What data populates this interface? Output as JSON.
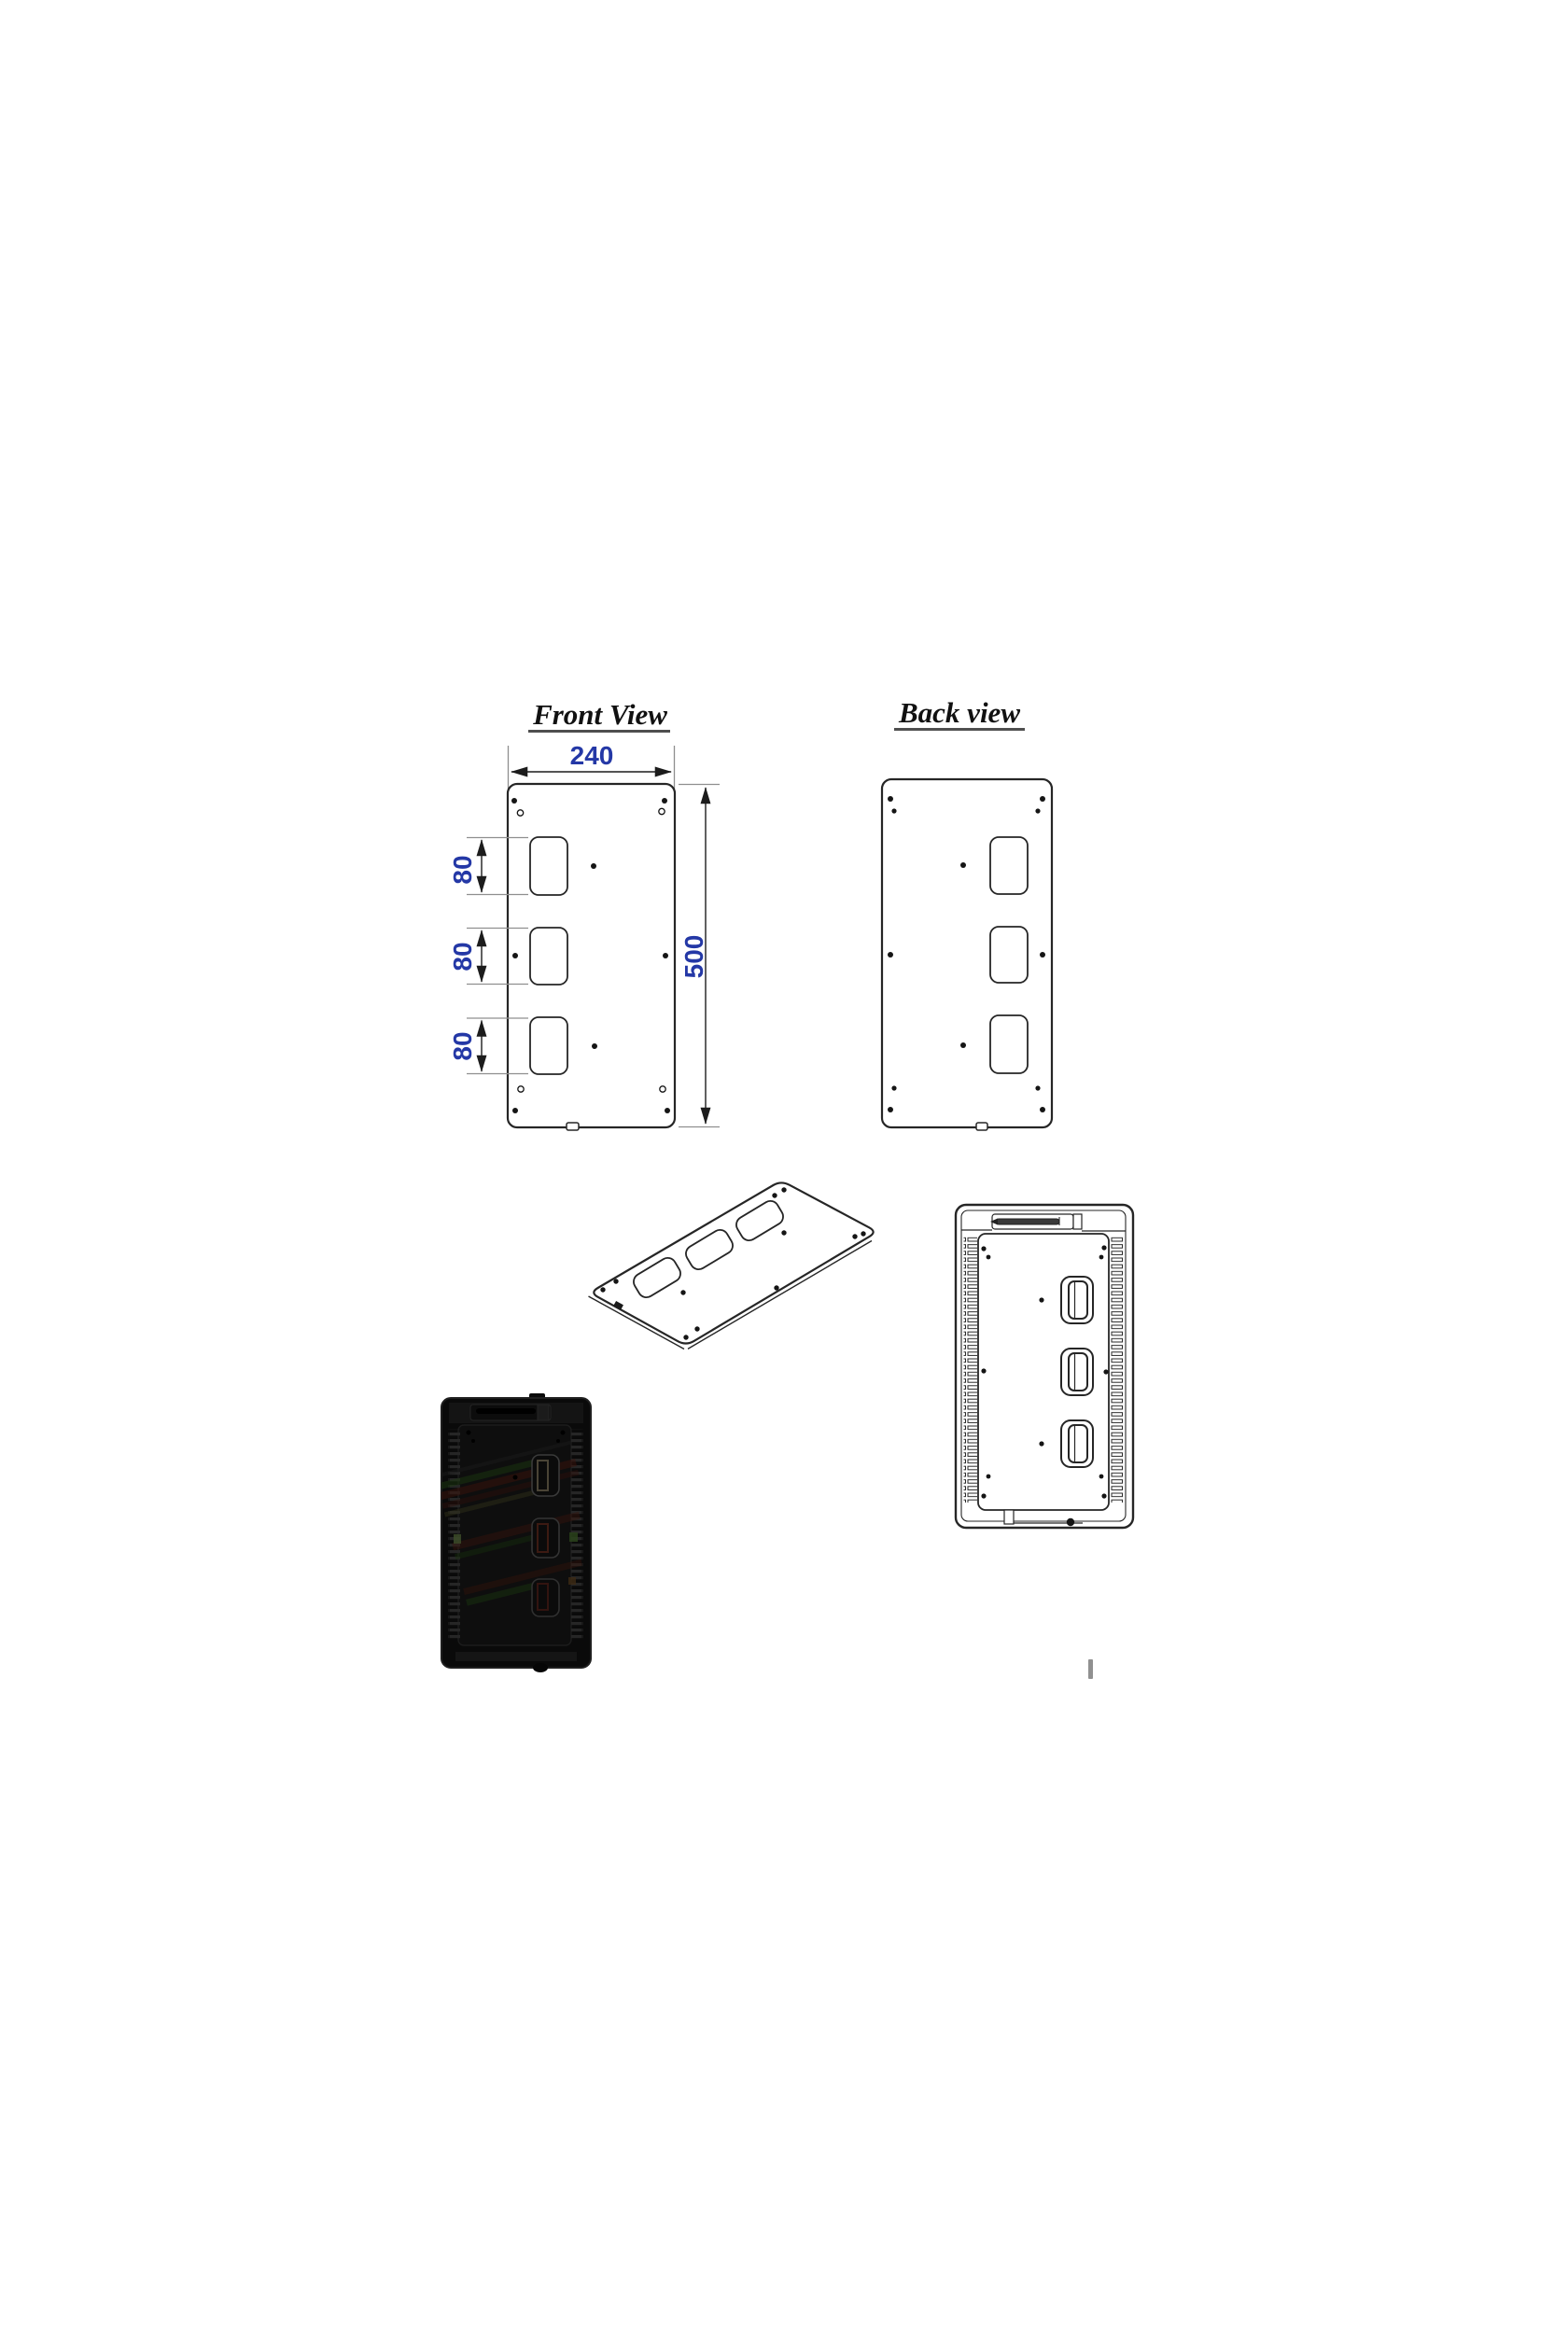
{
  "page": {
    "background": "#ffffff"
  },
  "drawing": {
    "front_view": {
      "title": "Front View",
      "width_label": "240",
      "height_label": "500",
      "pitch_labels": [
        "80",
        "80",
        "80"
      ]
    },
    "back_view": {
      "title": "Back view"
    }
  },
  "colors": {
    "outline": "#262626",
    "extension_line": "#8f8f8f",
    "dimension_text": "#2438a6",
    "title_text": "#111111",
    "title_underline": "#4f4f4f",
    "render_body": "#0a0a0a",
    "render_streak_red": "#3c120c",
    "render_streak_green": "#1c3a10",
    "render_streak_olive": "#32321a",
    "cursor_mark": "#909090"
  }
}
